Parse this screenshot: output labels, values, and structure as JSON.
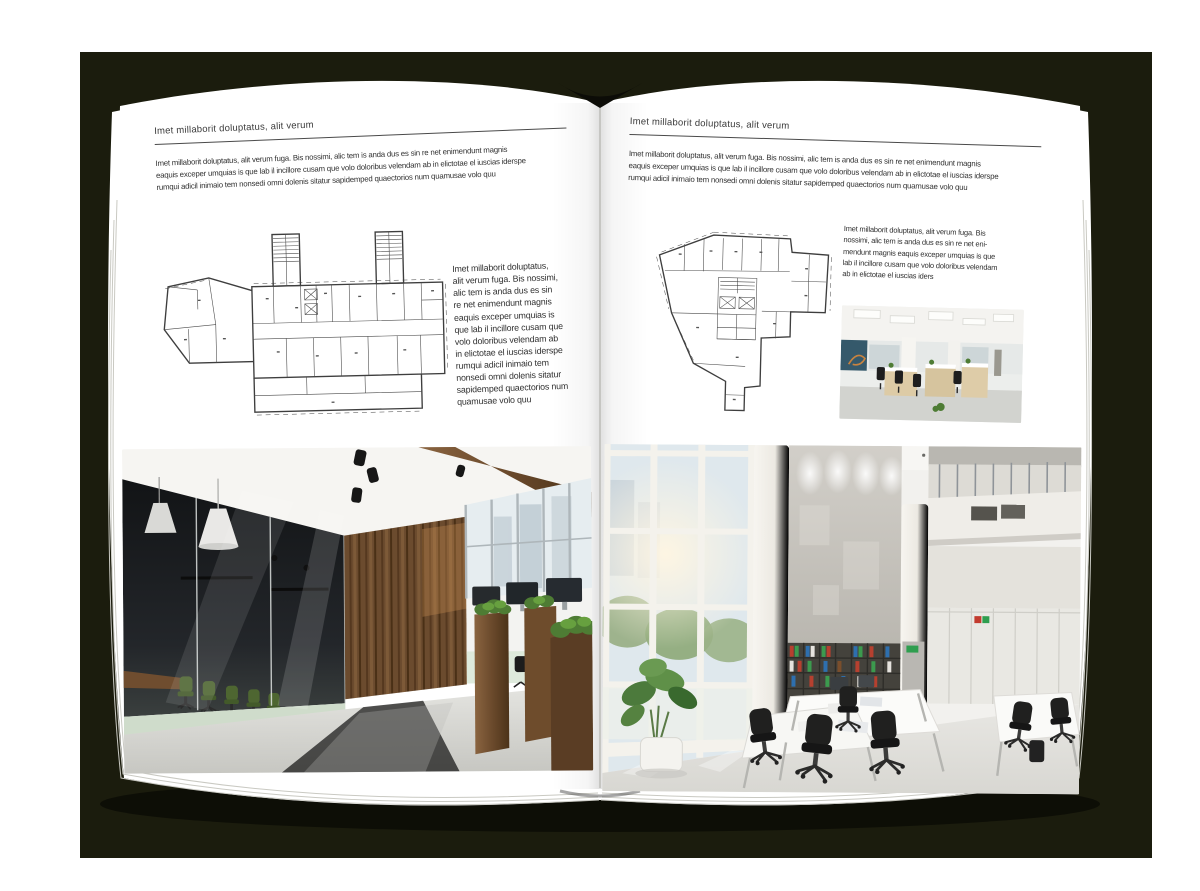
{
  "spread": {
    "type": "brochure-open-spread",
    "colors": {
      "backdrop": "#1b1c0d",
      "page": "#ffffff",
      "text": "#303030",
      "rule": "#4a4a4a"
    },
    "left_page": {
      "header": "Imet millaborit doluptatus, alit verum",
      "intro": "Imet millaborit doluptatus, alit verum fuga. Bis nossimi, alic tem is anda dus es sin re net enimendunt magnis\neaquis exceper umquias is que lab il incillore cusam que volo doloribus velendam ab in elictotae el iuscias iderspe\nrumqui adicil inimaio tem nonsedi omni dolenis sitatur sapidemped quaectorios num quamusae volo quu",
      "side_text": "Imet millaborit doluptatus,\nalit verum fuga. Bis nossimi,\nalic tem is anda dus es sin\nre net enimendunt magnis\neaquis exceper umquias is\nque lab il incillore cusam que\nvolo doloribus velendam ab\nin elictotae el iuscias iderspe\nrumqui adicil inimaio tem\nnonsedi omni dolenis sitatur\nsapidemped quaectorios num\nquamusae volo quu"
    },
    "right_page": {
      "header": "Imet millaborit doluptatus, alit verum",
      "intro": "Imet millaborit doluptatus, alit verum fuga. Bis nossimi, alic tem is anda dus es sin re net enimendunt magnis\neaquis exceper umquias is que lab il incillore cusam que volo doloribus velendam ab in elictotae el iuscias iderspe\nrumqui adicil inimaio tem nonsedi omni dolenis sitatur sapidemped quaectorios num quamusae volo quu",
      "side_text": "Imet millaborit doluptatus, alit verum fuga. Bis\nnossimi, alic tem is anda dus es sin re net eni-\nmendunt magnis eaquis exceper umquias is que\nlab il incillore cusam que volo doloribus velendam\nab in elictotae el iuscias iders"
    }
  }
}
